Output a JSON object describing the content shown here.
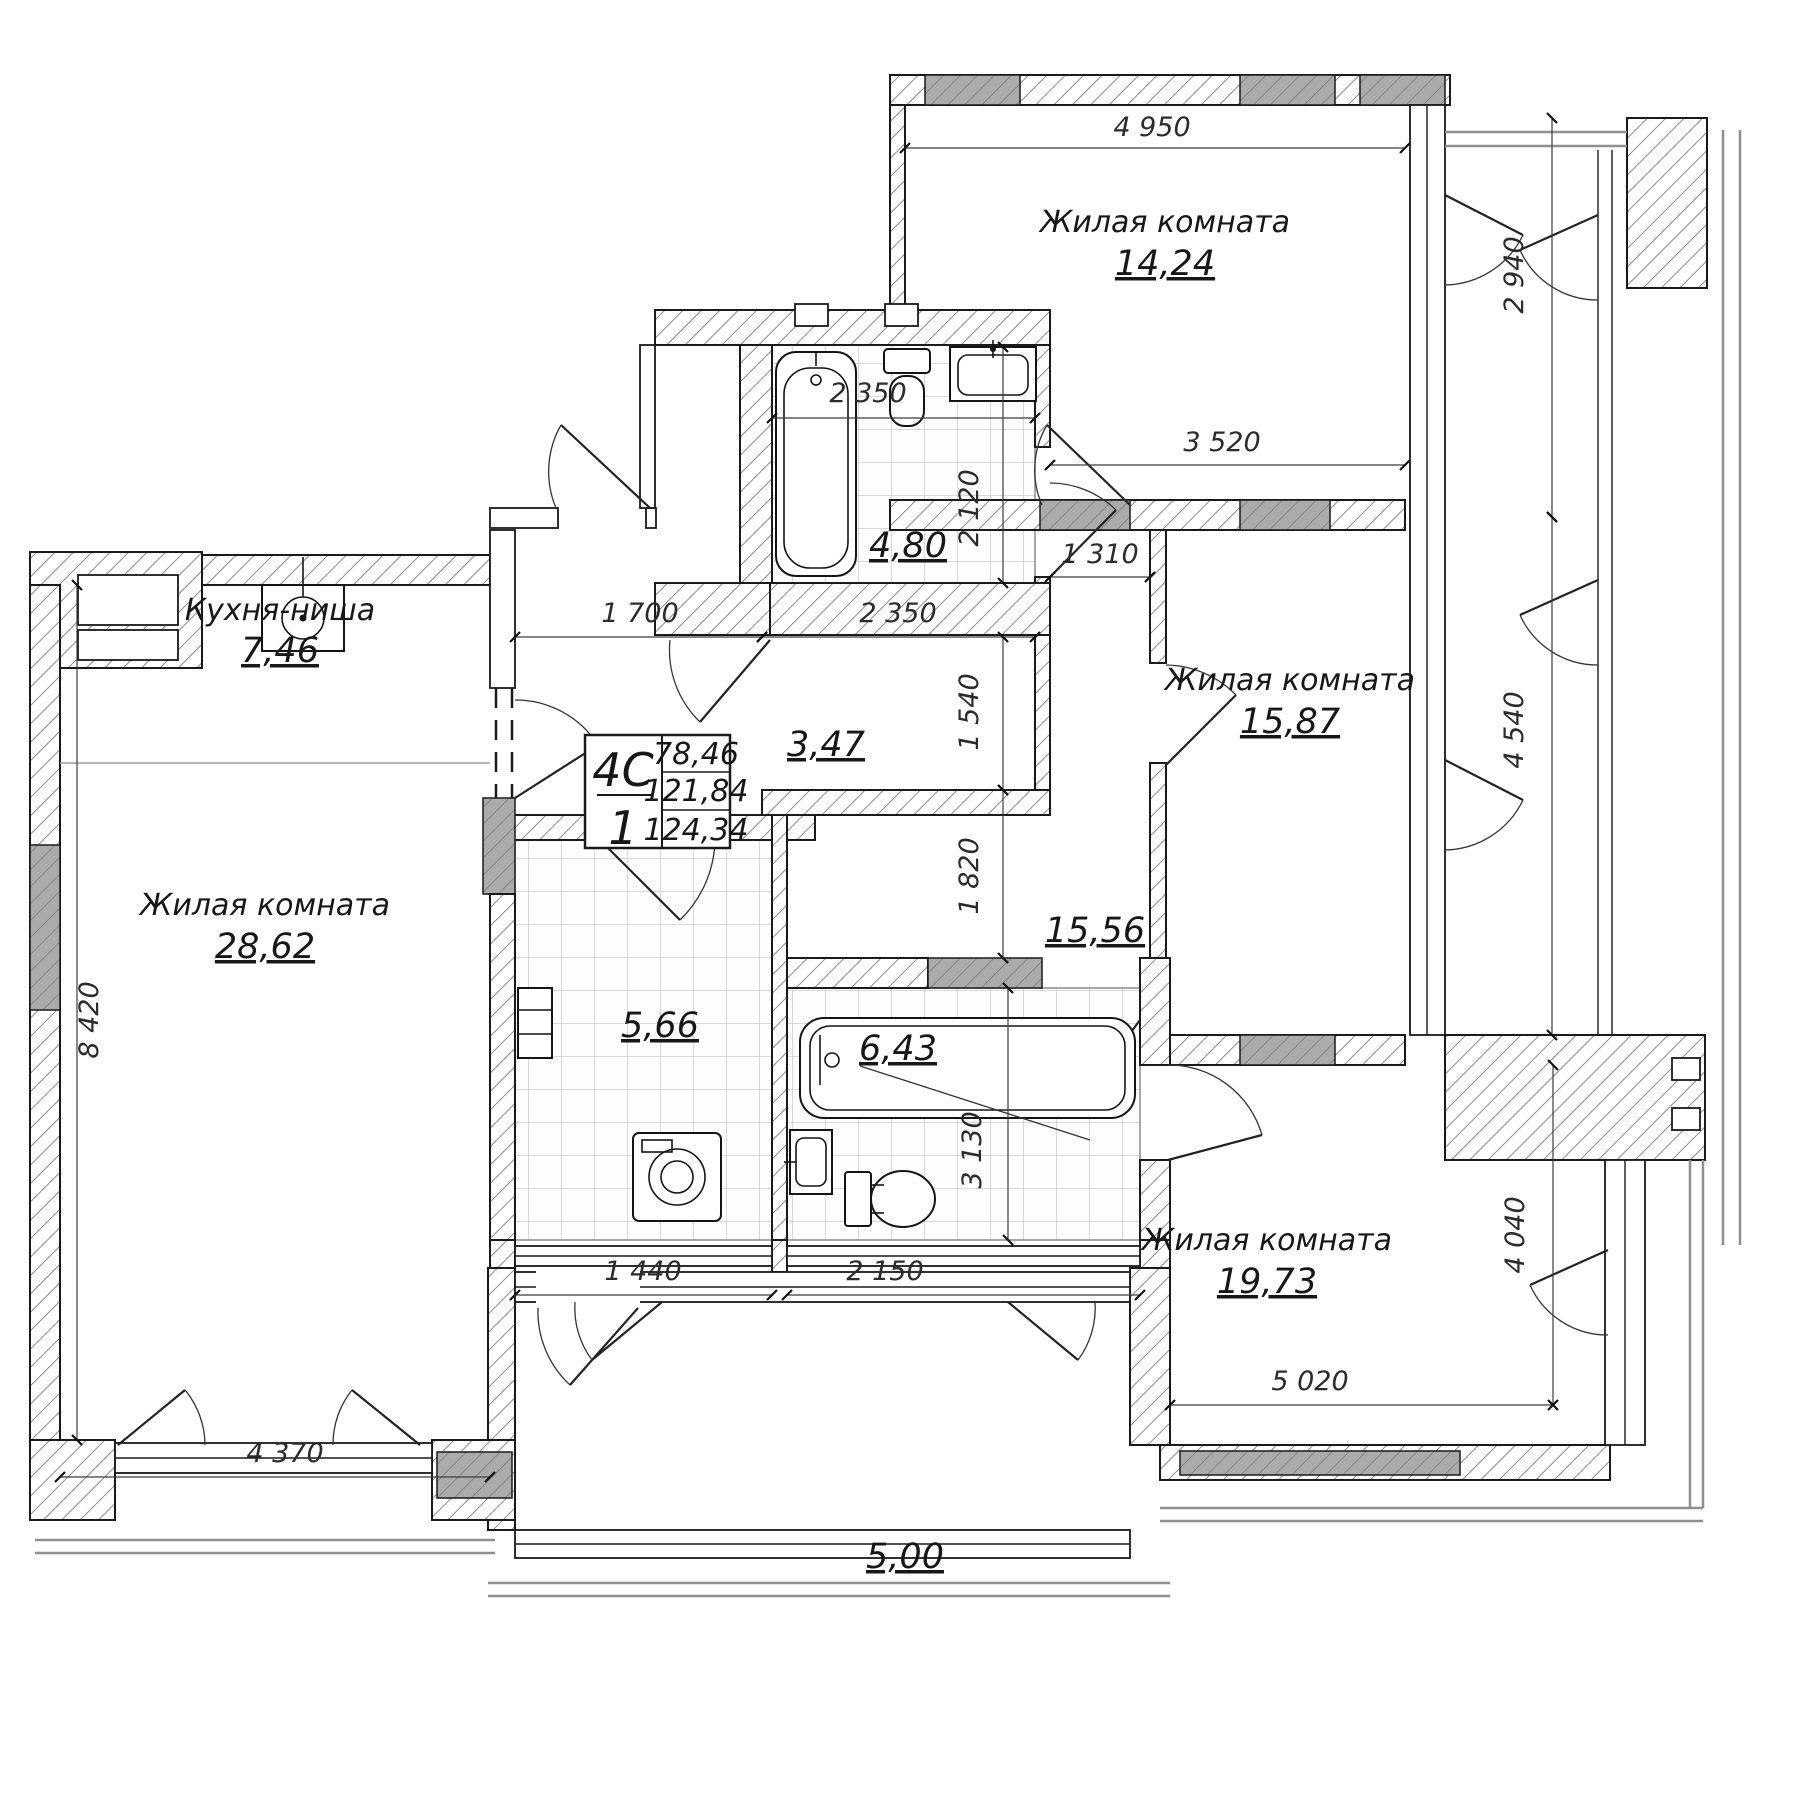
{
  "unit_card": {
    "type": "4C",
    "count": "1",
    "living_area": "78,46",
    "area": "121,84",
    "total_area": "124,34"
  },
  "rooms": {
    "room_top": {
      "name": "Жилая комната",
      "area": "14,24"
    },
    "room_mid": {
      "name": "Жилая комната",
      "area": "15,87"
    },
    "room_bottom": {
      "name": "Жилая комната",
      "area": "19,73"
    },
    "room_left": {
      "name": "Жилая комната",
      "area": "28,62"
    },
    "kitchen": {
      "name": "Кухня-ниша",
      "area": "7,46"
    },
    "bathroom": {
      "area": "4,80"
    },
    "hall": {
      "area": "3,47"
    },
    "corridor": {
      "area": "15,56"
    },
    "laundry": {
      "area": "5,66"
    },
    "bathroom2": {
      "area": "6,43"
    },
    "loggia": {
      "area": "5,00"
    }
  },
  "dims": {
    "room_top_w": "4 950",
    "room_top_h": "2 940",
    "mid_w": "3 520",
    "corridor_w": "1 310",
    "room_mid_h": "4 540",
    "bath_w_top": "2 350",
    "bath_h": "2 120",
    "entry_w": "1 700",
    "bath_w": "2 350",
    "hall_h": "1 540",
    "corr_h": "1 820",
    "left_h": "8 420",
    "left_w": "4 370",
    "laundry_w": "1 440",
    "bath2_w": "2 150",
    "bath2_h": "3 130",
    "room_bottom_w": "5 020",
    "room_bottom_h": "4 040"
  },
  "colors": {
    "line": "#1a1a1a",
    "hatch": "#6e6e6e",
    "lintel": "#ababab",
    "tile": "#c4c4c4",
    "dim_text": "#2b2b2b"
  }
}
